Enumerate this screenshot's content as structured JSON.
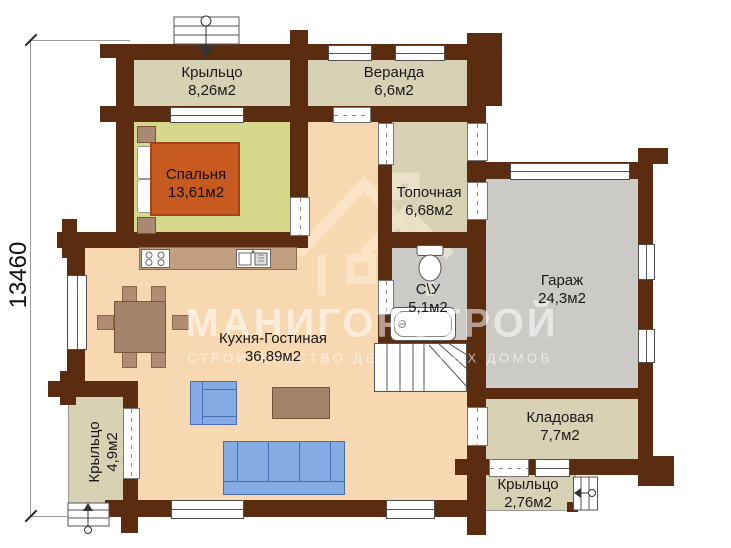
{
  "plan": {
    "dimension_left": "13460",
    "watermark": {
      "title": "МАНИГОРСТРОЙ",
      "subtitle": "СТРОИТЕЛЬСТВО ДЕРЕВЯННЫХ ДОМОВ"
    },
    "rooms": {
      "porch_top": {
        "name": "Крыльцо",
        "area": "8,26м2"
      },
      "veranda": {
        "name": "Веранда",
        "area": "6,6м2"
      },
      "bedroom": {
        "name": "Спальня",
        "area": "13,61м2"
      },
      "boiler": {
        "name": "Топочная",
        "area": "6,68м2"
      },
      "bathroom": {
        "name": "С\\У",
        "area": "5,1м2"
      },
      "garage": {
        "name": "Гараж",
        "area": "24,3м2"
      },
      "kitchen_living": {
        "name": "Кухня-Гостиная",
        "area": "36,89м2"
      },
      "storage": {
        "name": "Кладовая",
        "area": "7,7м2"
      },
      "porch_left": {
        "name": "Крыльцо",
        "area": "4,9м2"
      },
      "porch_bottom": {
        "name": "Крыльцо",
        "area": "2,76м2"
      }
    },
    "colors": {
      "wall": "#5b2c0f",
      "floor_porch": "#d8d2b5",
      "floor_bedroom": "#d5d78a",
      "floor_living": "#f8d8b0",
      "floor_garage": "#cbcac7",
      "bed": "#c75a1e",
      "upholstery_blue": "#84abe3",
      "wood_furniture": "#a5826a"
    }
  }
}
